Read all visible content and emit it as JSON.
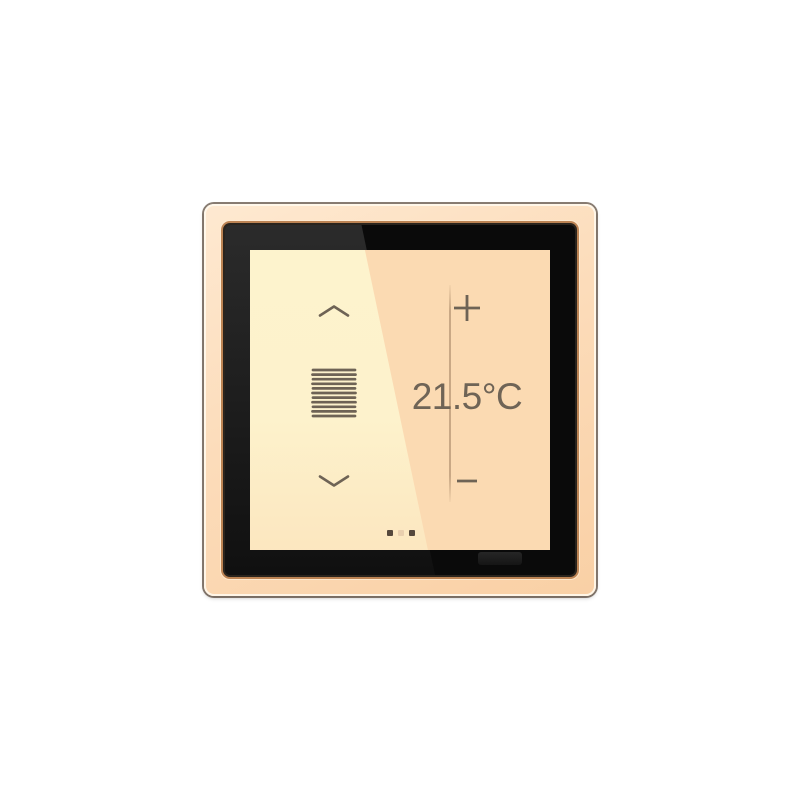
{
  "device": {
    "type": "smart room controller touch panel",
    "frame_finish": "peach"
  },
  "screen": {
    "shutter_panel": {
      "up_icon": "chevron-up",
      "blinds_icon": "venetian-blinds",
      "down_icon": "chevron-down"
    },
    "climate_panel": {
      "increase_icon": "plus",
      "temperature": "21.5°C",
      "temperature_value": "21.5",
      "temperature_unit": "°C",
      "decrease_icon": "minus"
    },
    "page_indicator": {
      "dots": [
        "active",
        "inactive",
        "active"
      ]
    },
    "proximity_sensor": "ir-sensor-window"
  },
  "colors": {
    "frame": "#fcdcba",
    "bezel": "#0a0a0a",
    "bevel_ring": "#bd8454",
    "screen_left": "#fdf3cd",
    "screen_right": "#fbdab2",
    "glyph": "#6e6355",
    "dot_active": "#55483c",
    "dot_inactive": "#e9cfae"
  }
}
